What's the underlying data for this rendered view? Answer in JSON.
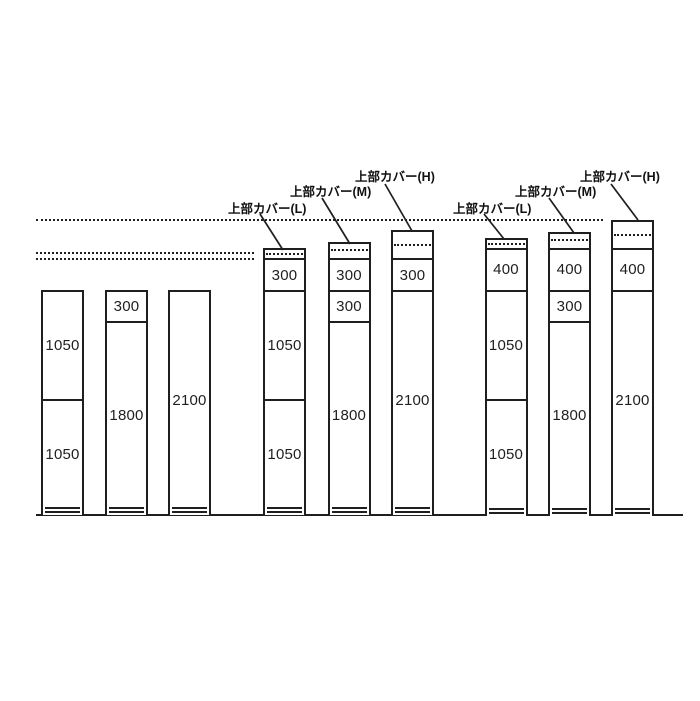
{
  "diagram": {
    "background": "#ffffff",
    "ink": "#1f1f1f",
    "scale_px_per_mm": 0.1042,
    "plinth_top_y": 508.5,
    "column_bottom_y": 515.5,
    "column_width": 43,
    "ground": {
      "x1": 36,
      "x2": 683,
      "y": 513.5
    },
    "guide_lines": [
      {
        "x1": 36,
        "x2": 603,
        "y": 218.5
      },
      {
        "x1": 36,
        "x2": 254,
        "y": 251.5
      },
      {
        "x1": 36,
        "x2": 254,
        "y": 257.5
      }
    ],
    "covers": {
      "L": {
        "label": "上部カバー(L)",
        "height_px": 10,
        "dot_offset_px": 3
      },
      "M": {
        "label": "上部カバー(M)",
        "height_px": 16,
        "dot_offset_px": 5
      },
      "H": {
        "label": "上部カバー(H)",
        "height_px": 28.5,
        "dot_offset_px": 12
      }
    },
    "columns": [
      {
        "x": 41,
        "cover": null,
        "sections": [
          {
            "label": "1050",
            "mm": 1050
          },
          {
            "label": "1050",
            "mm": 1050
          }
        ]
      },
      {
        "x": 105,
        "cover": null,
        "sections": [
          {
            "label": "300",
            "mm": 300
          },
          {
            "label": "1800",
            "mm": 1800
          }
        ]
      },
      {
        "x": 168,
        "cover": null,
        "sections": [
          {
            "label": "2100",
            "mm": 2100
          }
        ]
      },
      {
        "x": 263,
        "cover": "L",
        "sections": [
          {
            "label": "300",
            "mm": 300
          },
          {
            "label": "1050",
            "mm": 1050
          },
          {
            "label": "1050",
            "mm": 1050
          }
        ]
      },
      {
        "x": 327.5,
        "cover": "M",
        "sections": [
          {
            "label": "300",
            "mm": 300
          },
          {
            "label": "300",
            "mm": 300
          },
          {
            "label": "1800",
            "mm": 1800
          }
        ]
      },
      {
        "x": 391,
        "cover": "H",
        "sections": [
          {
            "label": "300",
            "mm": 300
          },
          {
            "label": "2100",
            "mm": 2100
          }
        ]
      },
      {
        "x": 484.5,
        "cover": "L",
        "sections": [
          {
            "label": "400",
            "mm": 400
          },
          {
            "label": "1050",
            "mm": 1050
          },
          {
            "label": "1050",
            "mm": 1050
          }
        ]
      },
      {
        "x": 548,
        "cover": "M",
        "sections": [
          {
            "label": "400",
            "mm": 400
          },
          {
            "label": "300",
            "mm": 300
          },
          {
            "label": "1800",
            "mm": 1800
          }
        ]
      },
      {
        "x": 611,
        "cover": "H",
        "sections": [
          {
            "label": "400",
            "mm": 400
          },
          {
            "label": "2100",
            "mm": 2100
          }
        ]
      }
    ],
    "callouts": [
      {
        "cover": "L",
        "x": 228,
        "y": 198,
        "leader": [
          260,
          214,
          283,
          250
        ]
      },
      {
        "cover": "M",
        "x": 290,
        "y": 181,
        "leader": [
          322,
          198,
          350,
          244
        ]
      },
      {
        "cover": "H",
        "x": 355,
        "y": 166,
        "leader": [
          385,
          184,
          412,
          231
        ]
      },
      {
        "cover": "L",
        "x": 453,
        "y": 198,
        "leader": [
          484,
          214,
          504,
          239
        ]
      },
      {
        "cover": "M",
        "x": 515,
        "y": 181,
        "leader": [
          549,
          198,
          574,
          233
        ]
      },
      {
        "cover": "H",
        "x": 580,
        "y": 166,
        "leader": [
          611,
          184,
          638,
          220
        ]
      }
    ]
  }
}
